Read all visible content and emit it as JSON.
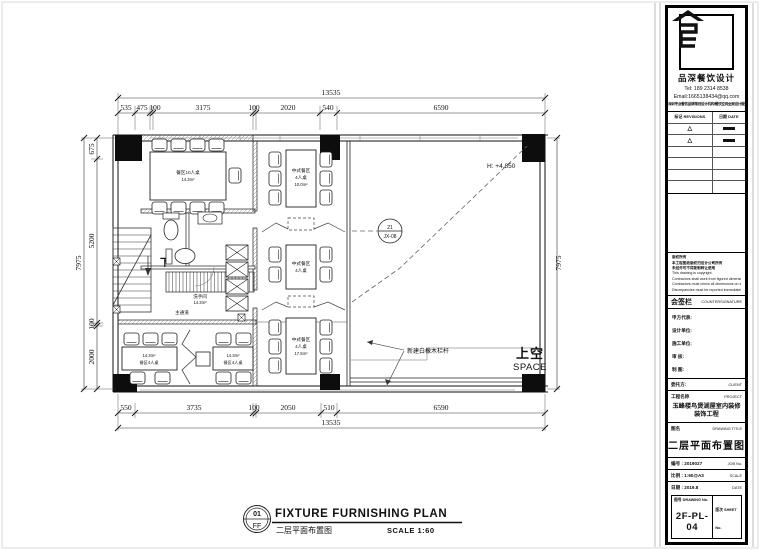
{
  "plan": {
    "dims": {
      "top_total": "13535",
      "top_segments": [
        "535",
        "475",
        "100",
        "3175",
        "100",
        "2020",
        "540",
        "6590"
      ],
      "bottom_segments": [
        "550",
        "3735",
        "100",
        "2050",
        "510",
        "6590"
      ],
      "bottom_total": "13535",
      "left_segments": [
        "675",
        "5200",
        "100",
        "2000"
      ],
      "left_total": "7975",
      "right_total": "7975"
    },
    "annotations": {
      "height_label": "H:  +4.850",
      "detail_tag_top": "21",
      "detail_tag_bottom": "JX-08",
      "railing_note": "新建白橡木栏杆",
      "void_label_cn": "上空",
      "void_label_en": "SPACE",
      "stair_down": "下"
    },
    "rooms": {
      "private": {
        "name": "餐区10人桌",
        "area": "14.3m²"
      },
      "wc": {
        "name": "洗手间",
        "area": "14.3m²"
      },
      "corridor": "主通道",
      "mid1": {
        "name": "中式餐区",
        "seats": "4人桌",
        "area": "10.0m²"
      },
      "mid2": {
        "name": "中式餐区",
        "seats": "4人桌"
      },
      "mid3": {
        "name": "中式餐区",
        "seats": "4人桌",
        "area": "17.5m²"
      },
      "low1": {
        "area": "14.3m²",
        "name": "餐区4人桌"
      },
      "low2": {
        "area": "14.3m²",
        "name": "餐区4人桌"
      }
    }
  },
  "view_title": {
    "number": "01",
    "sheet": "FF",
    "title_en": "FIXTURE FURNISHING PLAN",
    "title_cn": "二层平面布置图",
    "scale": "SCALE 1:60"
  },
  "titleblock": {
    "brand": "品深餐饮设计",
    "tel": "Tel: 189 2314 8538",
    "email": "Email:1665138434@qq.com",
    "tagline": "深圳专业餐饮品牌策划设计机构/餐饮空间全案设计服务商",
    "revisions": {
      "col_mark": "标记 REVISIONS",
      "col_date": "日期 DATE",
      "mark": "△"
    },
    "notes": [
      "版权所有",
      "本工程图纸版权归设计公司所有",
      "未经许可不得复制转让使用",
      "This drawing is copyright.",
      "Contractors shall work from figured dimensions only.",
      "Contractors must check all dimensions on site.",
      "Discrepancies must be reported immediately to architects."
    ],
    "countersign_cn": "会签栏",
    "countersign_en": "COUNTERSIGNATURE",
    "fields": [
      "甲方代表:",
      "设计单位:",
      "施工单位:",
      "审  核:",
      "制  图:"
    ],
    "client_cn": "委托方:",
    "client_en": "CLIENT",
    "project_label_cn": "工程名称",
    "project_label_en": "PROJECT",
    "project_name": "玉峰楼鸟煲湖屋室内装修装饰工程",
    "drawing_label_cn": "图名",
    "drawing_label_en": "DRAWING TITLE",
    "drawing_title": "二层平面布置图",
    "job_row": {
      "cn": "编号 : 2019027",
      "en": "JOB No."
    },
    "scale_row": {
      "cn": "比例 : 1:60@A3",
      "en": "SCALE"
    },
    "date_row": {
      "cn": "日期 : 2019.8",
      "en": "DATE"
    },
    "drawing_no_label": "图号 DRAWING No.",
    "drawing_no": "2F-PL-04",
    "sheet_no_label": "版次 SHEET No."
  }
}
